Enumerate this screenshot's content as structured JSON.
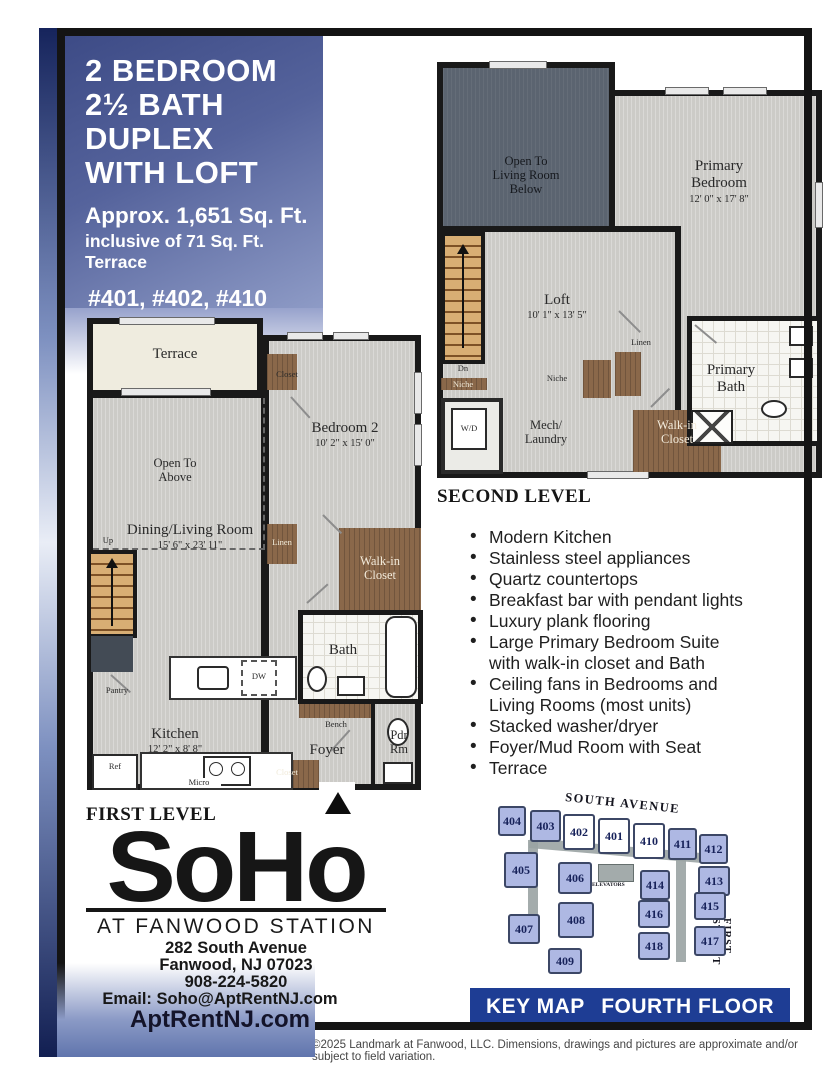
{
  "header": {
    "title_lines": [
      "2 BEDROOM",
      "2½ BATH",
      "DUPLEX",
      "WITH LOFT"
    ],
    "area": "Approx. 1,651 Sq. Ft.",
    "area_note": "inclusive of 71 Sq. Ft. Terrace",
    "units": "#401, #402, #410"
  },
  "second_level": {
    "heading": "SECOND LEVEL",
    "labels": {
      "open_below": "Open To\nLiving Room\nBelow",
      "primary_bedroom": "Primary\nBedroom",
      "primary_bedroom_dims": "12' 0\" x 17' 8\"",
      "loft": "Loft",
      "loft_dims": "10' 1\" x 13' 5\"",
      "dn": "Dn",
      "niche_left": "Niche",
      "niche_mid": "Niche",
      "wd": "W/D",
      "mech_laundry": "Mech/\nLaundry",
      "linen": "Linen",
      "walk_in_closet": "Walk-in\nCloset",
      "primary_bath": "Primary\nBath"
    }
  },
  "first_level": {
    "heading": "FIRST LEVEL",
    "labels": {
      "terrace": "Terrace",
      "closet_top": "Closet",
      "bedroom2": "Bedroom 2",
      "bedroom2_dims": "10' 2\" x 15' 0\"",
      "open_above": "Open To\nAbove",
      "dining": "Dining/Living Room",
      "dining_dims": "15' 6\" x 23' 11\"",
      "up": "Up",
      "linen": "Linen",
      "walk_in_closet": "Walk-in\nCloset",
      "bath": "Bath",
      "pantry": "Pantry",
      "dw": "DW",
      "kitchen": "Kitchen",
      "kitchen_dims": "12' 2\" x 8' 8\"",
      "ref": "Ref",
      "micro": "Micro",
      "closet_bottom": "Closet",
      "bench": "Bench",
      "foyer": "Foyer",
      "pdr": "Pdr\nRm"
    }
  },
  "features": [
    "Modern Kitchen",
    "Stainless steel appliances",
    "Quartz countertops",
    "Breakfast bar with pendant lights",
    "Luxury plank flooring",
    "Large Primary Bedroom Suite\nwith walk-in closet and Bath",
    "Ceiling fans in Bedrooms and\nLiving Rooms (most units)",
    "Stacked washer/dryer",
    "Foyer/Mud Room with Seat",
    "Terrace"
  ],
  "logo": {
    "name": "SoHo",
    "tagline": "AT FANWOOD STATION",
    "address_line1": "282 South Avenue",
    "address_line2": "Fanwood, NJ 07023",
    "phone": "908-224-5820",
    "email": "Email: Soho@AptRentNJ.com",
    "website": "AptRentNJ.com"
  },
  "key_map": {
    "title": "KEY MAP",
    "floor": "FOURTH FLOOR",
    "street_top": "SOUTH AVENUE",
    "street_right": "FIRST STREET",
    "elevators": "ELEVATORS",
    "units": [
      {
        "label": "404",
        "highlighted": false
      },
      {
        "label": "403",
        "highlighted": false
      },
      {
        "label": "402",
        "highlighted": true
      },
      {
        "label": "401",
        "highlighted": true
      },
      {
        "label": "410",
        "highlighted": true
      },
      {
        "label": "411",
        "highlighted": false
      },
      {
        "label": "412",
        "highlighted": false
      },
      {
        "label": "405",
        "highlighted": false
      },
      {
        "label": "406",
        "highlighted": false
      },
      {
        "label": "414",
        "highlighted": false
      },
      {
        "label": "413",
        "highlighted": false
      },
      {
        "label": "408",
        "highlighted": false
      },
      {
        "label": "416",
        "highlighted": false
      },
      {
        "label": "415",
        "highlighted": false
      },
      {
        "label": "407",
        "highlighted": false
      },
      {
        "label": "418",
        "highlighted": false
      },
      {
        "label": "417",
        "highlighted": false
      },
      {
        "label": "409",
        "highlighted": false
      }
    ]
  },
  "footer": {
    "copyright": "©2025 Landmark at Fanwood, LLC. Dimensions, drawings and pictures are approximate and/or subject to field variation."
  },
  "colors": {
    "accent_navy": "#1e3d94",
    "title_gradient_top": "#3d4b86",
    "title_gradient_bottom": "#8e9bc6",
    "keymap_unit_fill": "#aeb8e3",
    "keymap_highlight_fill": "#ffffff"
  }
}
